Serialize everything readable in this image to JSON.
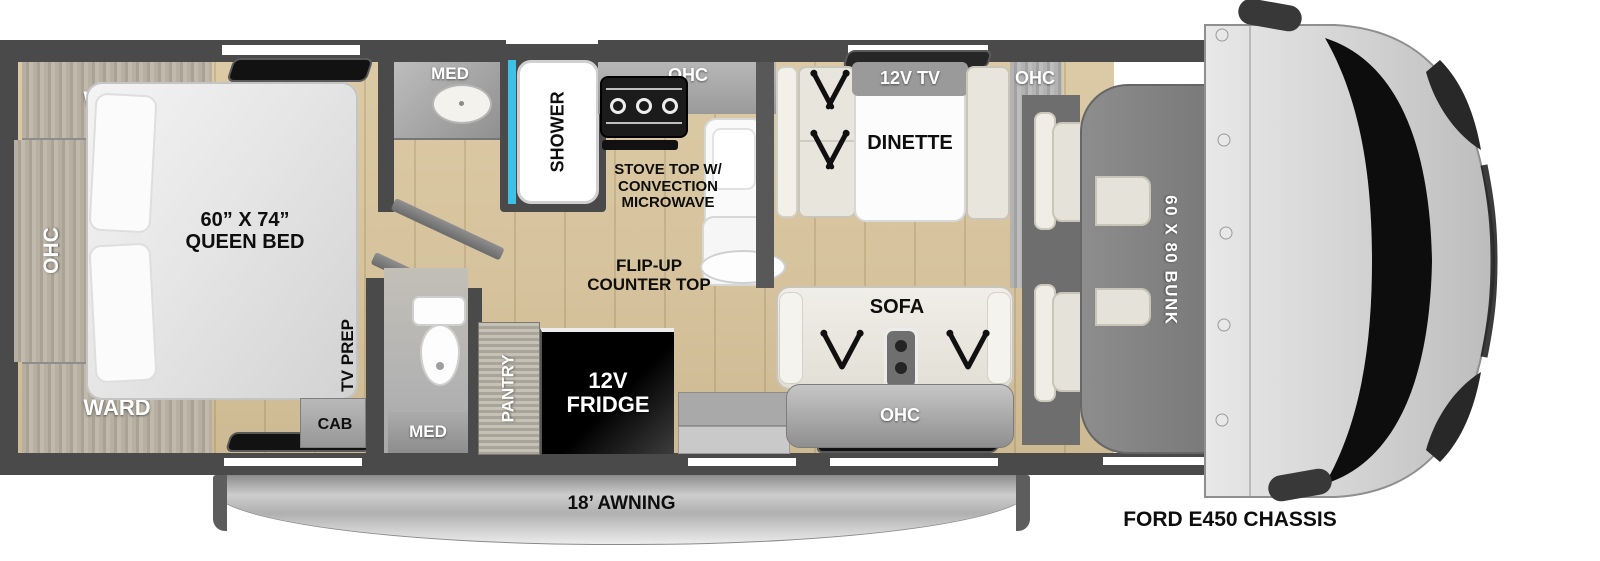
{
  "labels": {
    "bedroom": {
      "ward_top": "WARD",
      "ward_bottom": "WARD",
      "ohc_left": "OHC",
      "bed_size": "60” X 74”",
      "bed_name": "QUEEN BED",
      "tv_prep": "TV PREP",
      "cab": "CAB"
    },
    "bath": {
      "med_top": "MED",
      "shower": "SHOWER",
      "med_bottom": "MED"
    },
    "kitchen": {
      "ohc": "OHC",
      "stove_line1": "STOVE TOP W/",
      "stove_line2": "CONVECTION",
      "stove_line3": "MICROWAVE",
      "flip_line1": "FLIP-UP",
      "flip_line2": "COUNTER TOP",
      "pantry": "PANTRY",
      "fridge_line1": "12V",
      "fridge_line2": "FRIDGE"
    },
    "dinette": {
      "tv": "12V TV",
      "name": "DINETTE",
      "ohc": "OHC"
    },
    "sofa": {
      "name": "SOFA",
      "ohc": "OHC"
    },
    "bunk": "60 X 80 BUNK",
    "awning": "18’ AWNING",
    "chassis": "FORD E450 CHASSIS"
  },
  "colors": {
    "wall": "#4a4a4a",
    "floor_wood": "#d6c39d",
    "cabinet_gray": "#a6a6a6",
    "upholstery_cream": "#e8e5dc",
    "shower_accent_cyan": "#3ec1e6",
    "fridge_black": "#0d0d0d",
    "bunk_gray": "#828282",
    "awning_silver": "#c9c9c9",
    "window_black": "#121212"
  }
}
